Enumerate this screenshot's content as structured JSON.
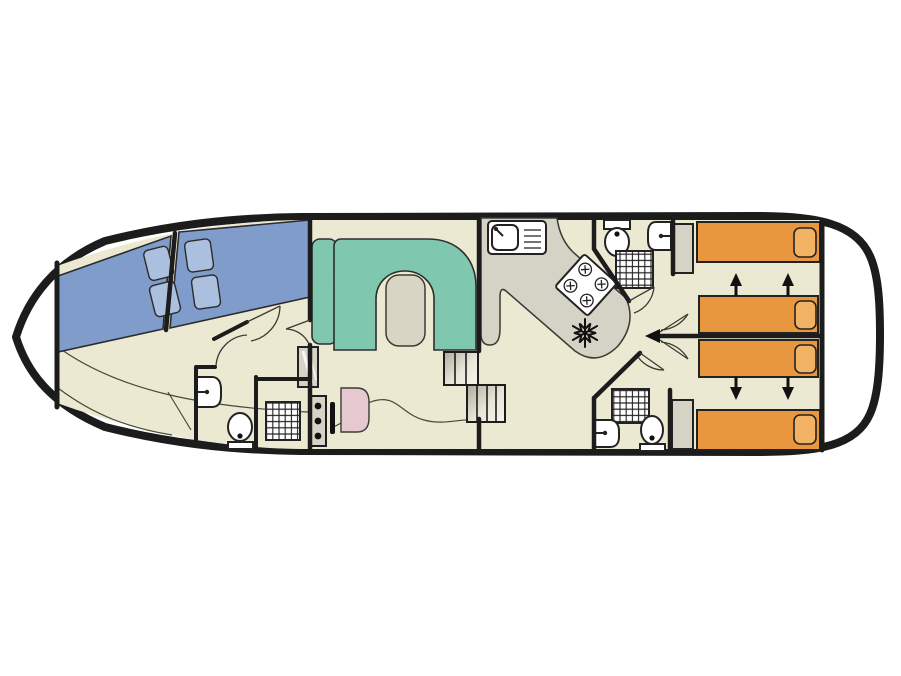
{
  "plan": {
    "type": "houseboat-deck-plan",
    "title": "",
    "colors": {
      "hull": "#1C1C1C",
      "floor": "#ECE9D3",
      "berth": "#7F9CCB",
      "berthpil": "#ABBFDF",
      "sofa": "#7FC8AF",
      "table": "#D8D5C4",
      "pinkseat": "#E6C9D0",
      "bed": "#E9973E",
      "bedpil": "#F2B264",
      "counter": "#D5D3C5",
      "fixture_white": "#FFFFFF"
    },
    "features": {
      "bow_double_berths": 2,
      "bow_berth_pillows": 4,
      "saloon_sofa_shape": "U",
      "saloon_table": 1,
      "helm_console_knobs": 3,
      "helm_seat": 1,
      "step_flights": 2,
      "galley_sink": 1,
      "stove_burners": 4,
      "fridge_snowflake": 1,
      "bathrooms": 3,
      "showers": 3,
      "toilets": 3,
      "washbasins": 3,
      "stern_single_beds": 4,
      "stern_bed_pillows": 4,
      "sliding_bed_arrows": 4,
      "wardrobes": 3
    }
  }
}
